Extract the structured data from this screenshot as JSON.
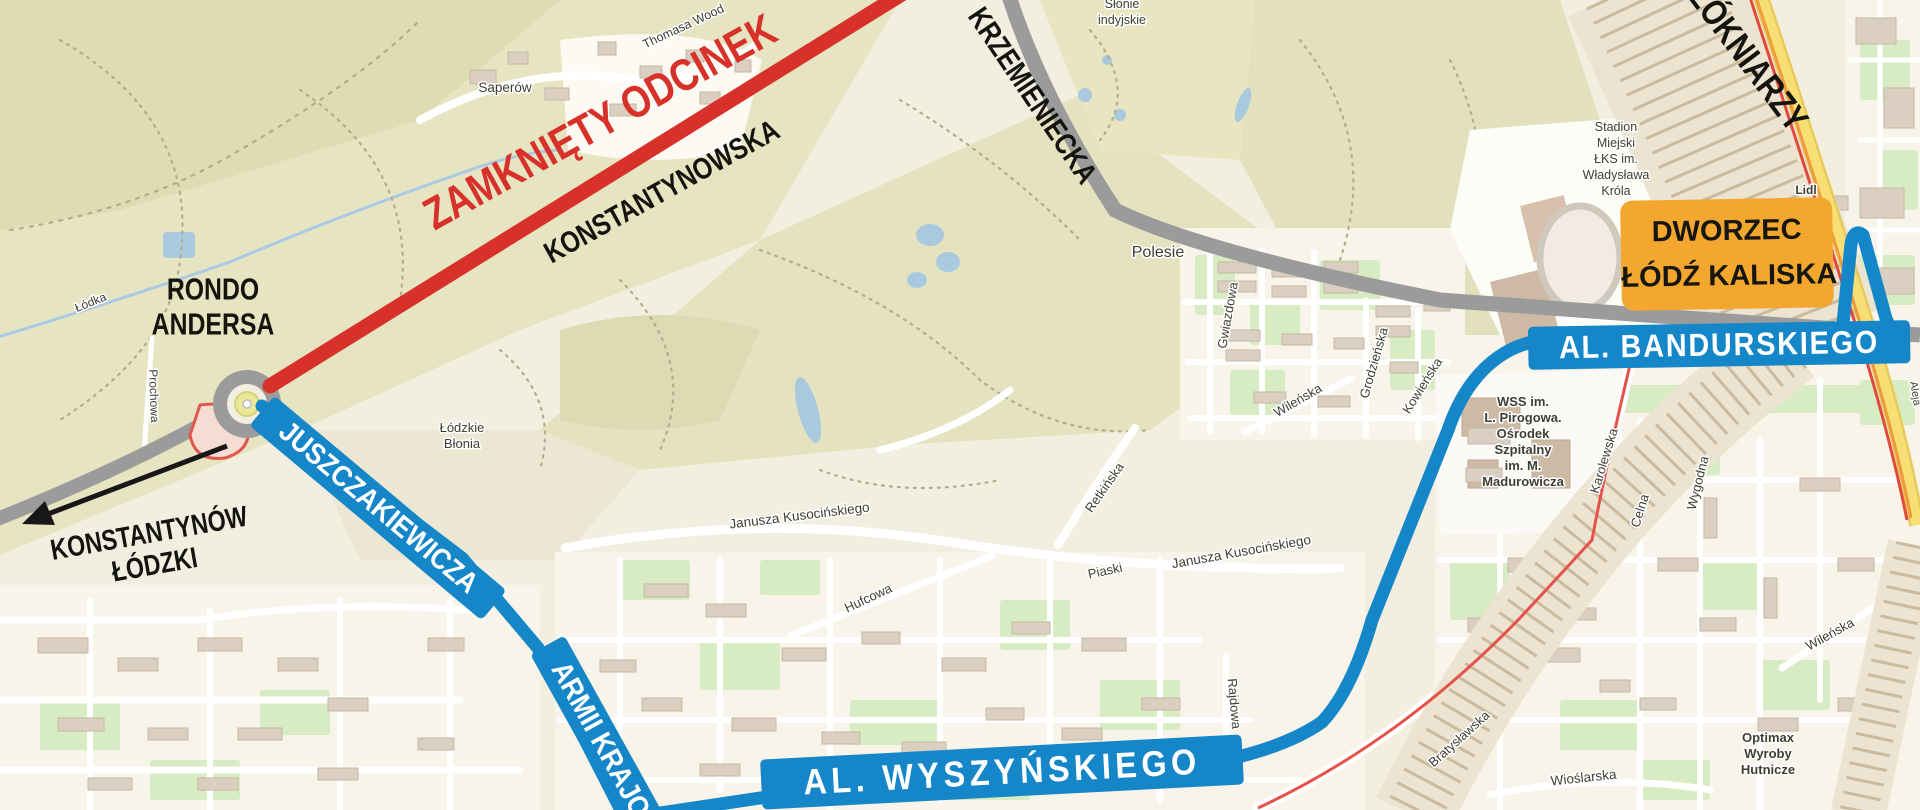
{
  "colors": {
    "detour_blue": "#1587c9",
    "closed_red": "#d7312a",
    "station_orange": "#f3a72e",
    "map_background": "#f3efe0",
    "park_olive": "#e6e3c2",
    "road_gray": "#9b9b9b"
  },
  "annotations": {
    "closed_section": "ZAMKNIĘTY ODCINEK",
    "road_konstantynowska": "KONSTANTYNOWSKA",
    "road_krzemieniecka": "KRZEMIENIECKA",
    "road_wlokniarzy": "ŁÓKNIARZY",
    "rondo_lines": [
      "RONDO",
      "ANDERSA"
    ],
    "direction_lines": [
      "KONSTANTYNÓW",
      "ŁÓDZKI"
    ],
    "station_lines": [
      "DWORZEC",
      "ŁÓDŹ KALISKA"
    ],
    "detour": {
      "juszczakiewicza": "JUSZCZAKIEWICZA",
      "armii_krajowej": "ARMII KRAJO",
      "wyszynskiego": "AL. WYSZYŃSKIEGO",
      "bandurskiego": "AL. BANDURSKIEGO"
    }
  },
  "map_labels": {
    "saperow": "Saperów",
    "thomasa_wooda": "Thomasa Wood",
    "slonie": [
      "Słonie",
      "indyjskie"
    ],
    "polesie": "Polesie",
    "gwiazdowa": "Gwiazdowa",
    "wilenska_1": "Wileńska",
    "grodzienska": "Grodzieńska",
    "kowienska": "Kowieńska",
    "lodzkie_blonia": [
      "Łódzkie",
      "Błonia"
    ],
    "lodka": "Łódka",
    "prochowa": "Prochowa",
    "kusocinskiego_1": "Janusza Kusocińskiego",
    "kusocinskiego_2": "Janusza Kusocińskiego",
    "retkinska": "Retkińska",
    "piaski": "Piaski",
    "hufcowa": "Hufcowa",
    "rajdowa": "Rajdowa",
    "bratyslawska": "Bratysławska",
    "wioslarska": "Wioślarska",
    "karolewska": "Karolewska",
    "celna": "Celna",
    "wygodna": "Wygodna",
    "wilenska_2": "Wileńska",
    "optimax": [
      "Optimax",
      "Wyroby",
      "Hutnicze"
    ],
    "hospital": [
      "WSS im.",
      "L. Pirogowa.",
      "Ośrodek",
      "Szpitalny",
      "im. M.",
      "Madurowicza"
    ],
    "stadium": [
      "Stadion",
      "Miejski",
      "ŁKS im.",
      "Władysława",
      "Króla"
    ],
    "lidl": "Lidl",
    "aleja": "Aleja"
  }
}
